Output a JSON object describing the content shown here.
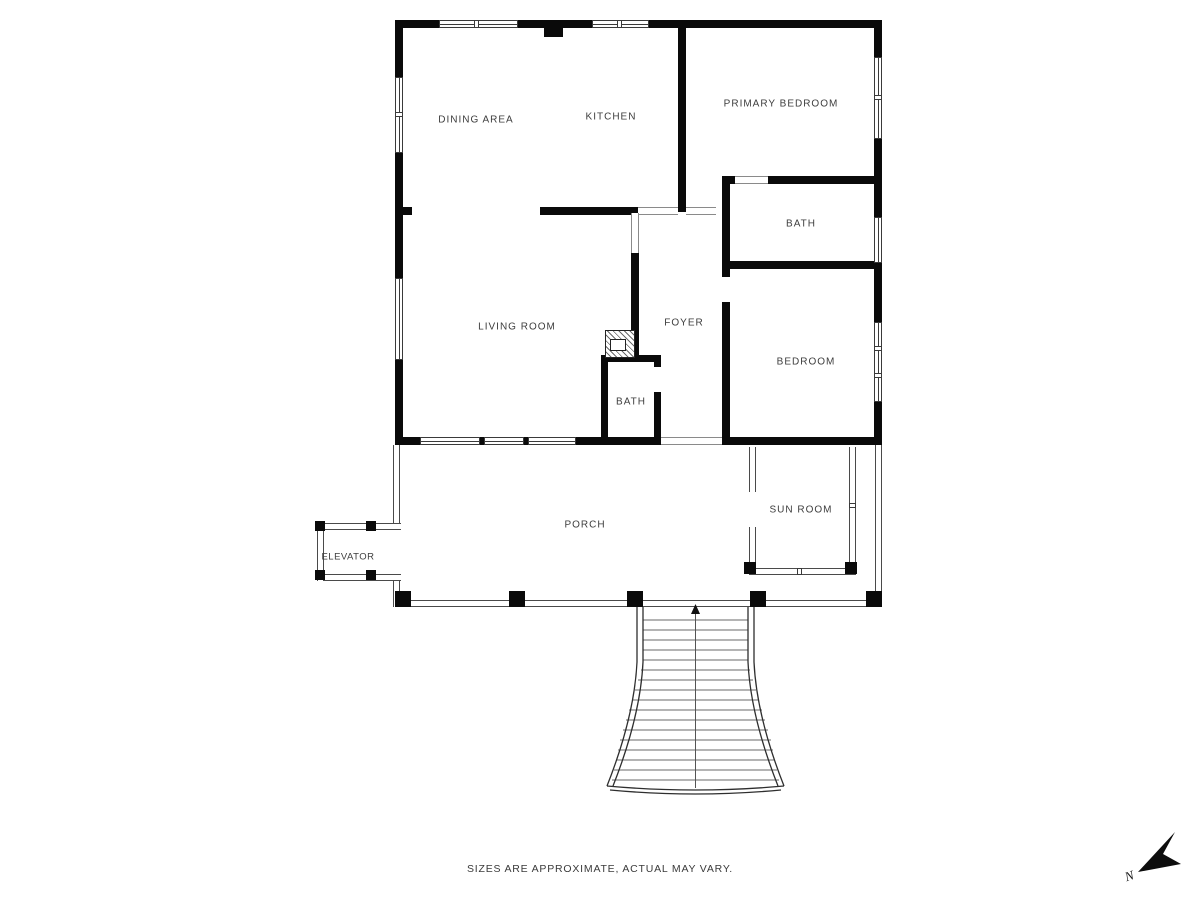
{
  "floorplan": {
    "rooms": [
      {
        "id": "dining-area",
        "label": "DINING AREA"
      },
      {
        "id": "kitchen",
        "label": "KITCHEN"
      },
      {
        "id": "primary-bedroom",
        "label": "PRIMARY BEDROOM"
      },
      {
        "id": "bath-upper",
        "label": "BATH"
      },
      {
        "id": "living-room",
        "label": "LIVING ROOM"
      },
      {
        "id": "foyer",
        "label": "FOYER"
      },
      {
        "id": "bedroom",
        "label": "BEDROOM"
      },
      {
        "id": "bath-lower",
        "label": "BATH"
      },
      {
        "id": "sun-room",
        "label": "SUN ROOM"
      },
      {
        "id": "porch",
        "label": "PORCH"
      },
      {
        "id": "elevator",
        "label": "ELEVATOR"
      }
    ],
    "compass": {
      "label": "N"
    },
    "disclaimer": "SIZES ARE APPROXIMATE, ACTUAL MAY VARY.",
    "colors": {
      "wall": "#0a0a0a",
      "label_text": "#3d3d3d",
      "thin_line": "#4a4a4a",
      "background": "#ffffff"
    }
  }
}
